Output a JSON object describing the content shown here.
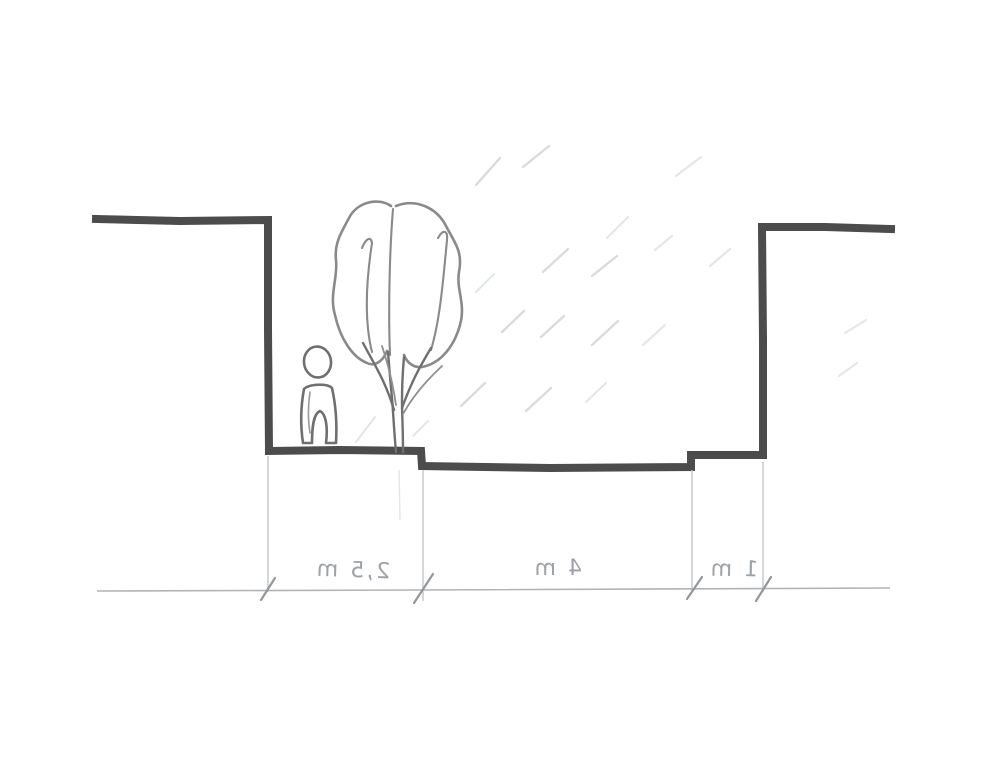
{
  "figure": {
    "kind": "hand-drawn street/section sketch",
    "text_mirrored": true
  },
  "dimensions": [
    {
      "id": "left-span",
      "label": "2,5 m"
    },
    {
      "id": "middle-span",
      "label": "4 m"
    },
    {
      "id": "right-span",
      "label": "1 m"
    }
  ],
  "colors": {
    "heavy_line": "#4c4c4c",
    "figure_line": "#6f6f6f",
    "tree_line": "#8a8a8a",
    "light_line": "#c3c7ca",
    "dim_line": "#b0b4b7",
    "tick": "#93979a",
    "label": "#9ea2a6",
    "hatch": "#d9dcdf",
    "background": "#ffffff"
  }
}
